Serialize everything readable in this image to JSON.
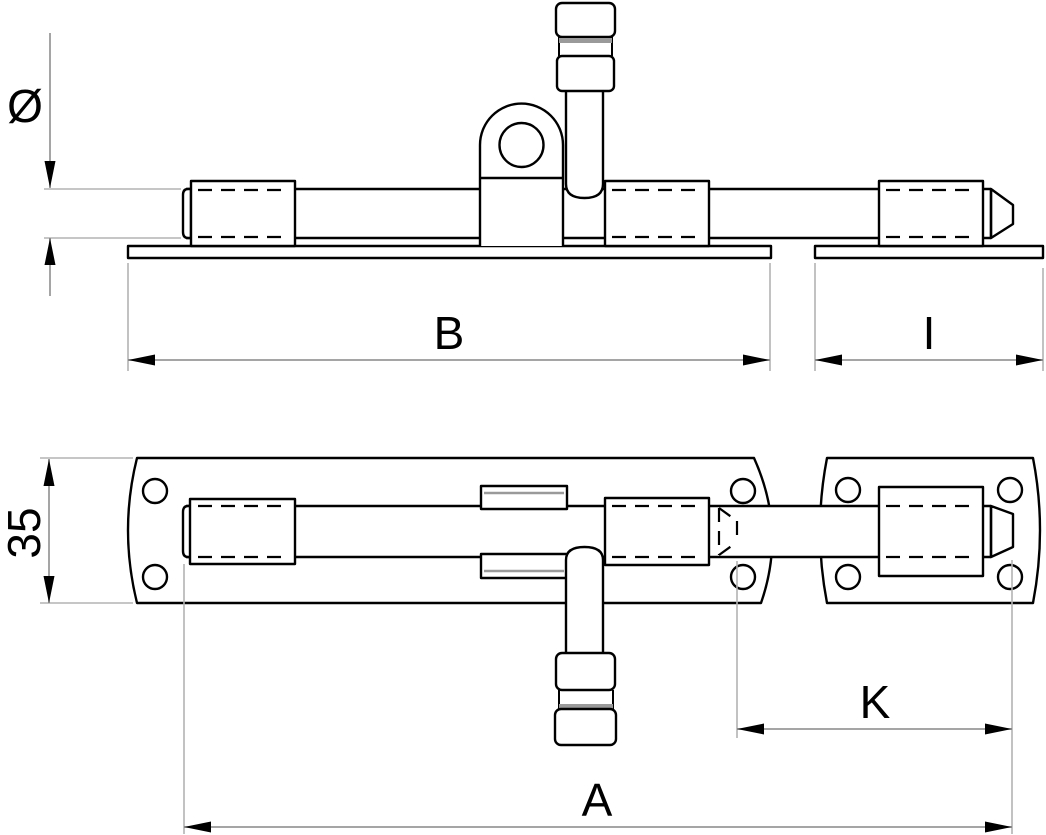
{
  "drawing": {
    "labels": {
      "diameter": "Ø",
      "main_plate_length": "B",
      "keeper_plate_length": "I",
      "plate_width": "35",
      "bolt_travel": "K",
      "overall_bolt_length": "A"
    },
    "colors": {
      "line": "#000000",
      "dimension": "#878787",
      "extension": "#b3b3b3",
      "accent": "#9a9a9a",
      "background": "#ffffff"
    }
  }
}
